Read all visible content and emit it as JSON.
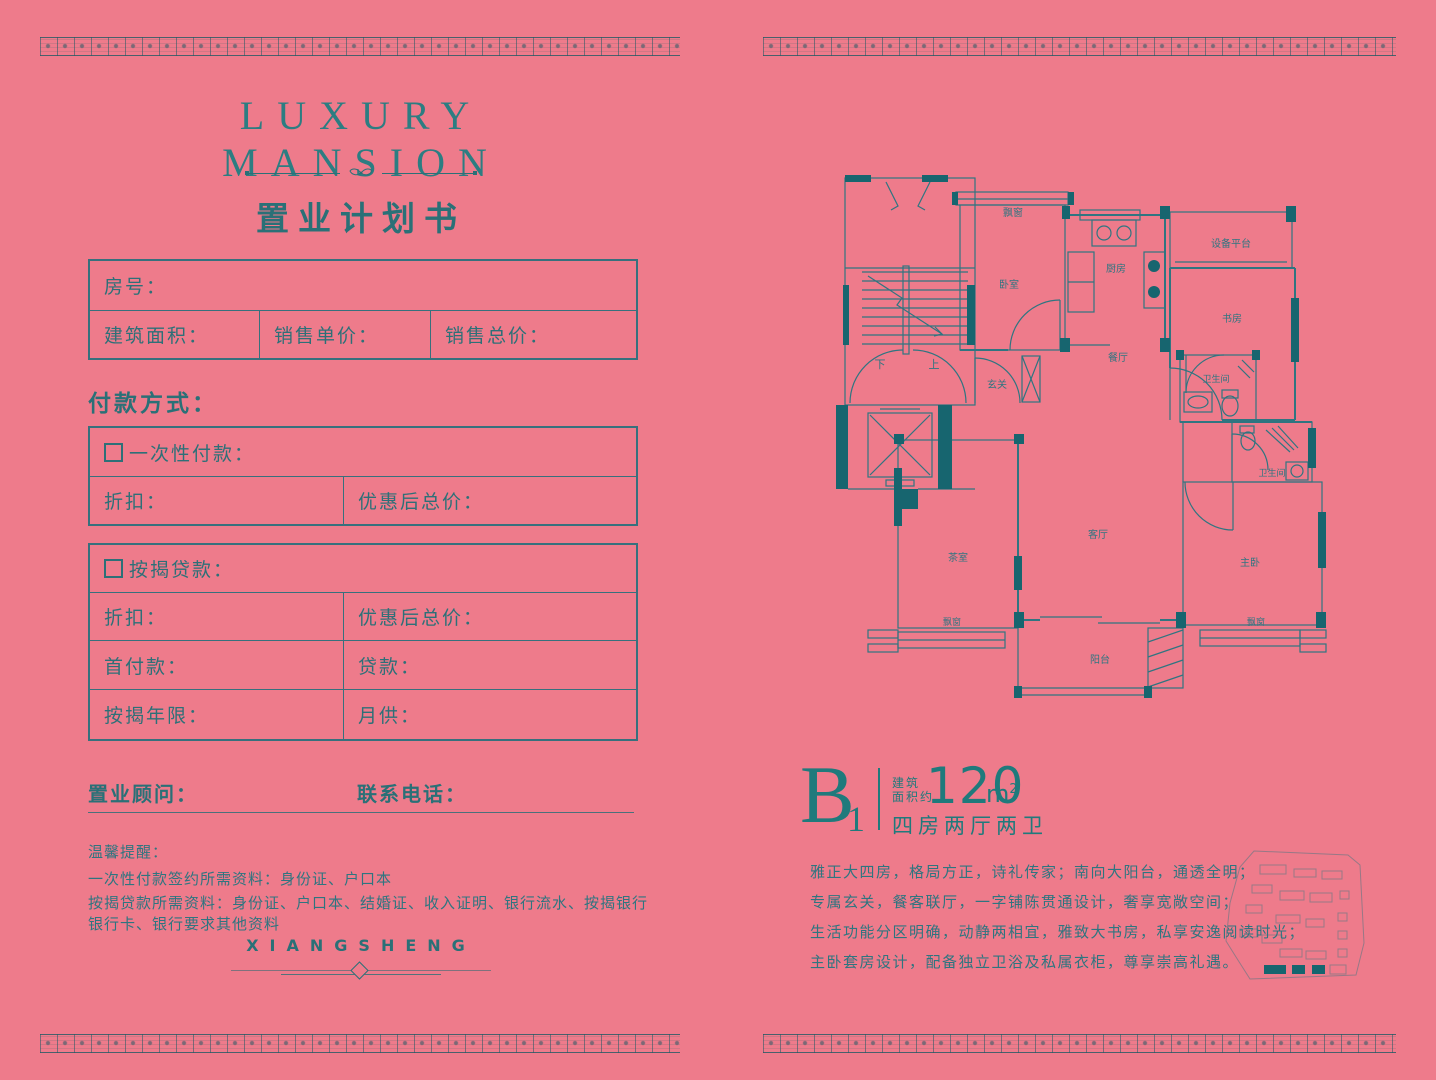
{
  "colors": {
    "background": "#ee7b8b",
    "teal_text": "#2a7077",
    "teal_dark_fill": "#17656f",
    "plan_line": "#2f7581"
  },
  "left": {
    "brand_title": "LUXURY MANSION",
    "doc_title": "置业计划书",
    "info": {
      "room": "房号：",
      "area": "建筑面积：",
      "unit_price": "销售单价：",
      "total_price": "销售总价："
    },
    "payment_heading": "付款方式：",
    "one_time": {
      "title": "一次性付款：",
      "discount": "折扣：",
      "total": "优惠后总价："
    },
    "mortgage": {
      "title": "按揭贷款：",
      "discount": "折扣：",
      "total": "优惠后总价：",
      "down_payment": "首付款：",
      "loan": "贷款：",
      "years": "按揭年限：",
      "monthly": "月供："
    },
    "consultant": "置业顾问：",
    "phone": "联系电话：",
    "reminder_title": "温馨提醒：",
    "reminder_line1": "一次性付款签约所需资料：身份证、户口本",
    "reminder_line2": "按揭贷款所需资料：身份证、户口本、结婚证、收入证明、银行流水、按揭银行银行卡、银行要求其他资料",
    "brand_footer": "XIANGSHENG"
  },
  "right": {
    "unit_code": "B",
    "unit_code_sub": "1",
    "area_label_line1": "建筑",
    "area_label_line2": "面积约",
    "area_value": "120",
    "area_unit": "m",
    "area_unit_sup": "2",
    "layout_text": "四房两厅两卫",
    "desc": [
      "雅正大四房，格局方正，诗礼传家；南向大阳台，通透全明；",
      "专属玄关，餐客联厅，一字铺陈贯通设计，奢享宽敞空间；",
      "生活功能分区明确，动静两相宜，雅致大书房，私享安逸阅读时光；",
      "主卧套房设计，配备独立卫浴及私属衣柜，尊享崇高礼遇。"
    ],
    "plan_labels": {
      "bay_top": "飘窗",
      "bedroom": "卧室",
      "kitchen": "厨房",
      "equipment": "设备平台",
      "study": "书房",
      "dining": "餐厅",
      "foyer": "玄关",
      "bath1": "卫生间",
      "bath2": "卫生间",
      "tea": "茶室",
      "living": "客厅",
      "master": "主卧",
      "bay_left": "飘窗",
      "bay_right": "飘窗",
      "balcony": "阳台",
      "down": "下",
      "up": "上"
    }
  }
}
